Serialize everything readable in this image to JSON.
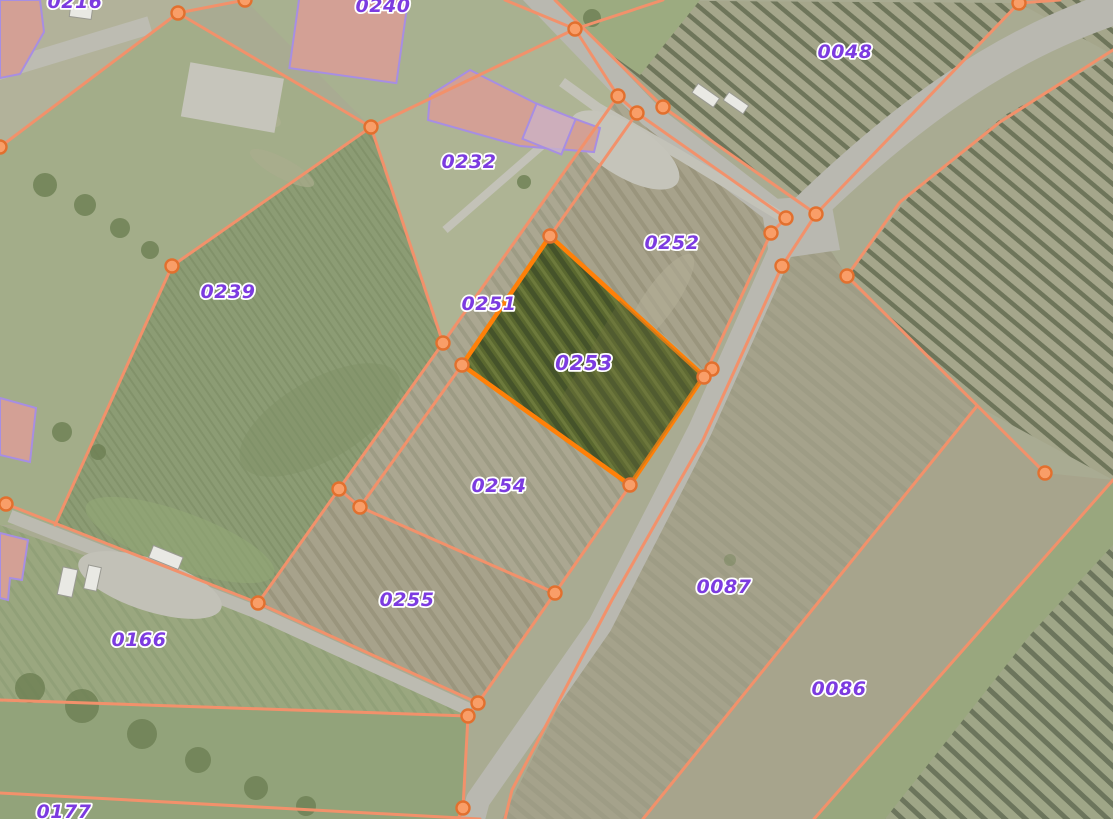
{
  "map": {
    "selected_parcel": "0253",
    "layer_names": {
      "imagery": "aerial-imagery",
      "cadastre": "parcel-boundaries",
      "labels": "parcel-numbers"
    },
    "parcels": [
      {
        "label": "0216",
        "x": 75,
        "y": 8
      },
      {
        "label": "0240",
        "x": 383,
        "y": 12
      },
      {
        "label": "0048",
        "x": 845,
        "y": 58
      },
      {
        "label": "0232",
        "x": 469,
        "y": 168
      },
      {
        "label": "0252",
        "x": 672,
        "y": 249
      },
      {
        "label": "0239",
        "x": 228,
        "y": 298
      },
      {
        "label": "0251",
        "x": 489,
        "y": 310
      },
      {
        "label": "0253",
        "x": 584,
        "y": 370
      },
      {
        "label": "0254",
        "x": 499,
        "y": 492
      },
      {
        "label": "0255",
        "x": 407,
        "y": 606
      },
      {
        "label": "0166",
        "x": 139,
        "y": 646
      },
      {
        "label": "0087",
        "x": 724,
        "y": 593
      },
      {
        "label": "0086",
        "x": 839,
        "y": 695
      },
      {
        "label": "0177",
        "x": 64,
        "y": 818
      }
    ],
    "colors": {
      "boundary": "#f2916b",
      "vertex_fill": "#f99e68",
      "vertex_stroke": "#e2702e",
      "selection": "#ff8008",
      "label": "#7c3be0",
      "label_halo": "#ffffff",
      "road": "#b9b8b0"
    }
  }
}
